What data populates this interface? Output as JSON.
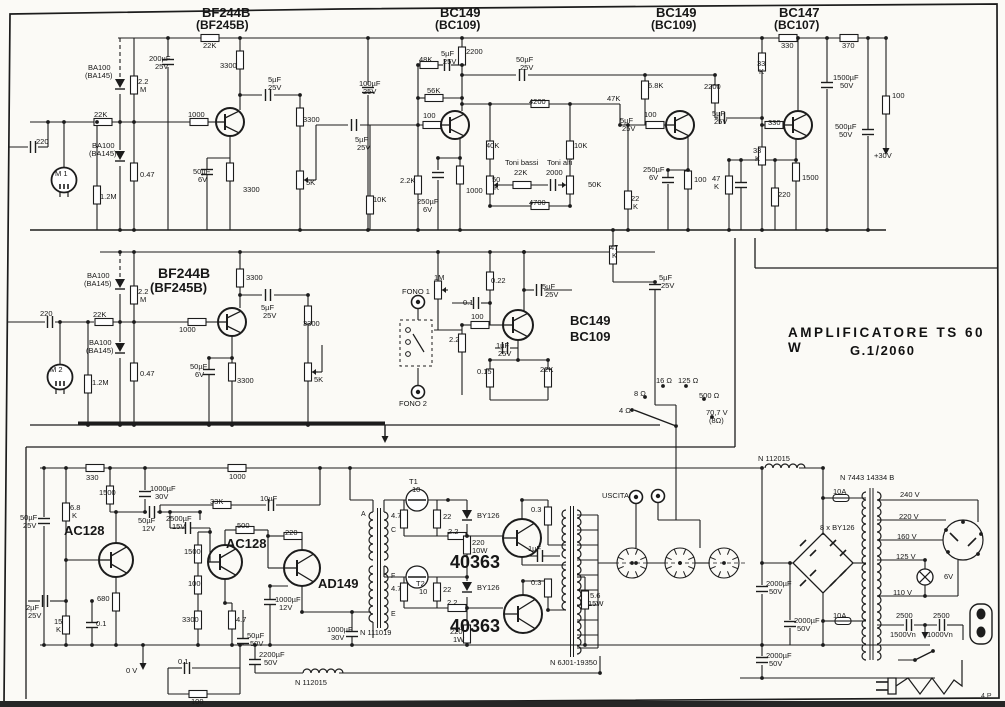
{
  "document": {
    "type": "schematic-scan",
    "title": "AMPLIFICATORE TS 60 W",
    "code": "G.1/2060",
    "page_mark": "4.P",
    "ink": "#1c1c1c",
    "paper": "#fbfaf6"
  },
  "sections": [
    {
      "name": "preamp-channel-1",
      "labels": [
        [
          202,
          6,
          "BF244B",
          13,
          1
        ],
        [
          196,
          19,
          "(BF245B)",
          12,
          1
        ],
        [
          440,
          6,
          "BC149",
          13,
          1
        ],
        [
          435,
          19,
          "(BC109)",
          12,
          1
        ],
        [
          656,
          6,
          "BC149",
          13,
          1
        ],
        [
          651,
          19,
          "(BC109)",
          12,
          1
        ],
        [
          779,
          6,
          "BC147",
          13,
          1
        ],
        [
          774,
          19,
          "(BC107)",
          12,
          1
        ],
        [
          203,
          42,
          "22K"
        ],
        [
          149,
          55,
          "200µF"
        ],
        [
          155,
          63,
          "25V"
        ],
        [
          220,
          62,
          "3300"
        ],
        [
          88,
          64,
          "BA100"
        ],
        [
          85,
          72,
          "(BA145)"
        ],
        [
          138,
          78,
          "2.2"
        ],
        [
          140,
          86,
          "M"
        ],
        [
          268,
          76,
          "5µF"
        ],
        [
          268,
          84,
          "25V"
        ],
        [
          94,
          111,
          "22K"
        ],
        [
          188,
          111,
          "1000"
        ],
        [
          303,
          116,
          "3300"
        ],
        [
          36,
          138,
          "220"
        ],
        [
          92,
          142,
          "BA100"
        ],
        [
          89,
          150,
          "(BA145)"
        ],
        [
          55,
          170,
          "M 1"
        ],
        [
          140,
          171,
          "0.47"
        ],
        [
          193,
          168,
          "50µF"
        ],
        [
          198,
          176,
          "6V"
        ],
        [
          243,
          186,
          "3300"
        ],
        [
          306,
          179,
          "5K"
        ],
        [
          100,
          193,
          "1.2M"
        ],
        [
          359,
          80,
          "100µF"
        ],
        [
          363,
          88,
          "25V"
        ],
        [
          419,
          56,
          "48K"
        ],
        [
          441,
          50,
          "5µF"
        ],
        [
          443,
          58,
          "25V"
        ],
        [
          466,
          48,
          "2200"
        ],
        [
          427,
          87,
          "56K"
        ],
        [
          423,
          112,
          "100"
        ],
        [
          516,
          56,
          "50µF"
        ],
        [
          520,
          64,
          "25V"
        ],
        [
          355,
          136,
          "5µF"
        ],
        [
          357,
          144,
          "25V"
        ],
        [
          373,
          196,
          "10K"
        ],
        [
          400,
          177,
          "2.2K"
        ],
        [
          417,
          198,
          "250µF"
        ],
        [
          423,
          206,
          "6V"
        ],
        [
          466,
          187,
          "1000"
        ],
        [
          486,
          142,
          "40K"
        ],
        [
          529,
          98,
          "4200"
        ],
        [
          505,
          159,
          "Toni bassi"
        ],
        [
          514,
          169,
          "22K"
        ],
        [
          547,
          159,
          "Toni alti"
        ],
        [
          546,
          169,
          "2000"
        ],
        [
          574,
          142,
          "10K"
        ],
        [
          492,
          176,
          "50"
        ],
        [
          494,
          184,
          "K"
        ],
        [
          588,
          181,
          "50K"
        ],
        [
          529,
          199,
          "4700"
        ],
        [
          607,
          95,
          "47K"
        ],
        [
          620,
          117,
          "5µF"
        ],
        [
          622,
          125,
          "25V"
        ],
        [
          648,
          82,
          "6.8K"
        ],
        [
          644,
          111,
          "100"
        ],
        [
          704,
          83,
          "2200"
        ],
        [
          712,
          110,
          "5µF"
        ],
        [
          714,
          118,
          "25V"
        ],
        [
          643,
          166,
          "250µF"
        ],
        [
          649,
          174,
          "6V"
        ],
        [
          694,
          176,
          "100"
        ],
        [
          631,
          195,
          "22"
        ],
        [
          633,
          203,
          "K"
        ],
        [
          712,
          175,
          "47"
        ],
        [
          714,
          183,
          "K"
        ],
        [
          757,
          60,
          "33"
        ],
        [
          759,
          68,
          "K"
        ],
        [
          768,
          119,
          "330"
        ],
        [
          753,
          147,
          "33"
        ],
        [
          755,
          155,
          "K"
        ],
        [
          781,
          42,
          "330"
        ],
        [
          842,
          42,
          "370"
        ],
        [
          833,
          74,
          "1500µF"
        ],
        [
          840,
          82,
          "50V"
        ],
        [
          835,
          123,
          "500µF"
        ],
        [
          839,
          131,
          "50V"
        ],
        [
          892,
          92,
          "100"
        ],
        [
          874,
          152,
          "+30V"
        ],
        [
          778,
          191,
          "220"
        ],
        [
          802,
          174,
          "1500"
        ]
      ]
    },
    {
      "name": "preamp-channel-2",
      "labels": [
        [
          158,
          266,
          "BF244B",
          14,
          1
        ],
        [
          150,
          281,
          "(BF245B)",
          13,
          1
        ],
        [
          87,
          272,
          "BA100"
        ],
        [
          84,
          280,
          "(BA145)"
        ],
        [
          138,
          288,
          "2.2"
        ],
        [
          140,
          296,
          "M"
        ],
        [
          246,
          274,
          "3300"
        ],
        [
          40,
          310,
          "220"
        ],
        [
          93,
          311,
          "22K"
        ],
        [
          179,
          326,
          "1000"
        ],
        [
          89,
          339,
          "BA100"
        ],
        [
          86,
          347,
          "(BA145)"
        ],
        [
          261,
          304,
          "5µF"
        ],
        [
          263,
          312,
          "25V"
        ],
        [
          303,
          320,
          "3300"
        ],
        [
          50,
          366,
          "M 2"
        ],
        [
          140,
          370,
          "0.47"
        ],
        [
          190,
          363,
          "50µF"
        ],
        [
          195,
          371,
          "6V"
        ],
        [
          237,
          377,
          "3300"
        ],
        [
          314,
          376,
          "5K"
        ],
        [
          92,
          379,
          "1.2M"
        ]
      ]
    },
    {
      "name": "phono-stage",
      "labels": [
        [
          570,
          314,
          "BC149",
          13,
          1
        ],
        [
          570,
          330,
          "BC109",
          13,
          1
        ],
        [
          434,
          274,
          "1M"
        ],
        [
          402,
          288,
          "FONO 1"
        ],
        [
          463,
          299,
          "0.1"
        ],
        [
          491,
          277,
          "0.22"
        ],
        [
          542,
          283,
          "5µF"
        ],
        [
          545,
          291,
          "25V"
        ],
        [
          471,
          313,
          "100"
        ],
        [
          449,
          336,
          "2.2"
        ],
        [
          496,
          342,
          "1µF"
        ],
        [
          498,
          350,
          "25V"
        ],
        [
          477,
          368,
          "0.15"
        ],
        [
          540,
          366,
          "22K"
        ],
        [
          399,
          400,
          "FONO 2"
        ],
        [
          610,
          244,
          "47"
        ],
        [
          612,
          252,
          "K"
        ],
        [
          659,
          274,
          "5µF"
        ],
        [
          661,
          282,
          "25V"
        ]
      ]
    },
    {
      "name": "output-selector",
      "labels": [
        [
          656,
          377,
          "16 Ω"
        ],
        [
          678,
          377,
          "125 Ω"
        ],
        [
          634,
          390,
          "8 Ω"
        ],
        [
          699,
          392,
          "500 Ω"
        ],
        [
          619,
          407,
          "4 Ω"
        ],
        [
          706,
          409,
          "70,7 V"
        ],
        [
          709,
          417,
          "(8Ω)"
        ]
      ]
    },
    {
      "name": "power-amplifier",
      "labels": [
        [
          64,
          524,
          "AC128",
          13,
          1
        ],
        [
          226,
          537,
          "AC128",
          13,
          1
        ],
        [
          318,
          577,
          "AD149",
          13,
          1
        ],
        [
          450,
          553,
          "40363",
          18,
          1
        ],
        [
          450,
          617,
          "40363",
          18,
          1
        ],
        [
          86,
          474,
          "330"
        ],
        [
          229,
          473,
          "1000"
        ],
        [
          99,
          489,
          "1500"
        ],
        [
          150,
          485,
          "1000µF"
        ],
        [
          155,
          493,
          "30V"
        ],
        [
          70,
          504,
          "6.8"
        ],
        [
          72,
          512,
          "K"
        ],
        [
          210,
          498,
          "33K"
        ],
        [
          260,
          495,
          "10µF"
        ],
        [
          20,
          514,
          "50µF"
        ],
        [
          23,
          522,
          "25V"
        ],
        [
          138,
          517,
          "50µF"
        ],
        [
          142,
          525,
          "12V"
        ],
        [
          166,
          515,
          "2500µF"
        ],
        [
          172,
          523,
          "15V"
        ],
        [
          237,
          522,
          "500"
        ],
        [
          285,
          529,
          "220"
        ],
        [
          184,
          548,
          "1500"
        ],
        [
          188,
          580,
          "100"
        ],
        [
          182,
          616,
          "3300"
        ],
        [
          236,
          616,
          "4.7"
        ],
        [
          97,
          595,
          "680"
        ],
        [
          26,
          604,
          "2µF"
        ],
        [
          28,
          612,
          "25V"
        ],
        [
          54,
          618,
          "15"
        ],
        [
          56,
          626,
          "K"
        ],
        [
          96,
          620,
          "0.1"
        ],
        [
          275,
          596,
          "1000µF"
        ],
        [
          279,
          604,
          "12V"
        ],
        [
          247,
          632,
          "50µF"
        ],
        [
          250,
          640,
          "50V"
        ],
        [
          126,
          667,
          "0 V"
        ],
        [
          178,
          658,
          "0.1"
        ],
        [
          191,
          698,
          "100"
        ],
        [
          259,
          651,
          "2200µF"
        ],
        [
          264,
          659,
          "50V"
        ],
        [
          295,
          679,
          "N 112015"
        ],
        [
          327,
          626,
          "1000µF"
        ],
        [
          331,
          634,
          "30V"
        ],
        [
          409,
          478,
          "T1"
        ],
        [
          412,
          486,
          "10"
        ],
        [
          391,
          512,
          "4.7"
        ],
        [
          443,
          513,
          "22"
        ],
        [
          448,
          528,
          "2.2"
        ],
        [
          477,
          512,
          "BY126"
        ],
        [
          472,
          539,
          "220"
        ],
        [
          472,
          547,
          "10W"
        ],
        [
          531,
          506,
          "0.3"
        ],
        [
          416,
          580,
          "T2"
        ],
        [
          419,
          588,
          "10"
        ],
        [
          391,
          585,
          "4.7"
        ],
        [
          443,
          586,
          "22"
        ],
        [
          447,
          599,
          "2.2"
        ],
        [
          477,
          584,
          "BY126"
        ],
        [
          531,
          579,
          "0.3"
        ],
        [
          450,
          628,
          "220"
        ],
        [
          453,
          636,
          "1W"
        ],
        [
          528,
          545,
          "1µF"
        ],
        [
          590,
          592,
          "5.6"
        ],
        [
          588,
          600,
          "15W"
        ],
        [
          361,
          511,
          "A",
          7
        ],
        [
          391,
          527,
          "C",
          7
        ],
        [
          391,
          573,
          "F",
          7
        ],
        [
          391,
          611,
          "E",
          7
        ],
        [
          360,
          629,
          "N 111019"
        ],
        [
          550,
          659,
          "N 6J01-19350"
        ],
        [
          602,
          492,
          "USCITA"
        ]
      ]
    },
    {
      "name": "power-supply",
      "labels": [
        [
          758,
          455,
          "N 112015"
        ],
        [
          833,
          488,
          "10A"
        ],
        [
          840,
          474,
          "N 7443 14334 B"
        ],
        [
          820,
          524,
          "8 x BY126"
        ],
        [
          900,
          491,
          "240 V"
        ],
        [
          899,
          513,
          "220 V"
        ],
        [
          897,
          533,
          "160 V"
        ],
        [
          896,
          553,
          "125 V"
        ],
        [
          893,
          589,
          "110 V"
        ],
        [
          944,
          573,
          "6V"
        ],
        [
          833,
          612,
          "10A"
        ],
        [
          896,
          612,
          "2500"
        ],
        [
          890,
          631,
          "1500Vn"
        ],
        [
          933,
          612,
          "2500"
        ],
        [
          927,
          631,
          "1000Vn"
        ],
        [
          766,
          580,
          "2000µF"
        ],
        [
          769,
          588,
          "50V"
        ],
        [
          794,
          617,
          "2000µF"
        ],
        [
          797,
          625,
          "50V"
        ],
        [
          766,
          652,
          "2000µF"
        ],
        [
          769,
          660,
          "50V"
        ]
      ]
    }
  ]
}
